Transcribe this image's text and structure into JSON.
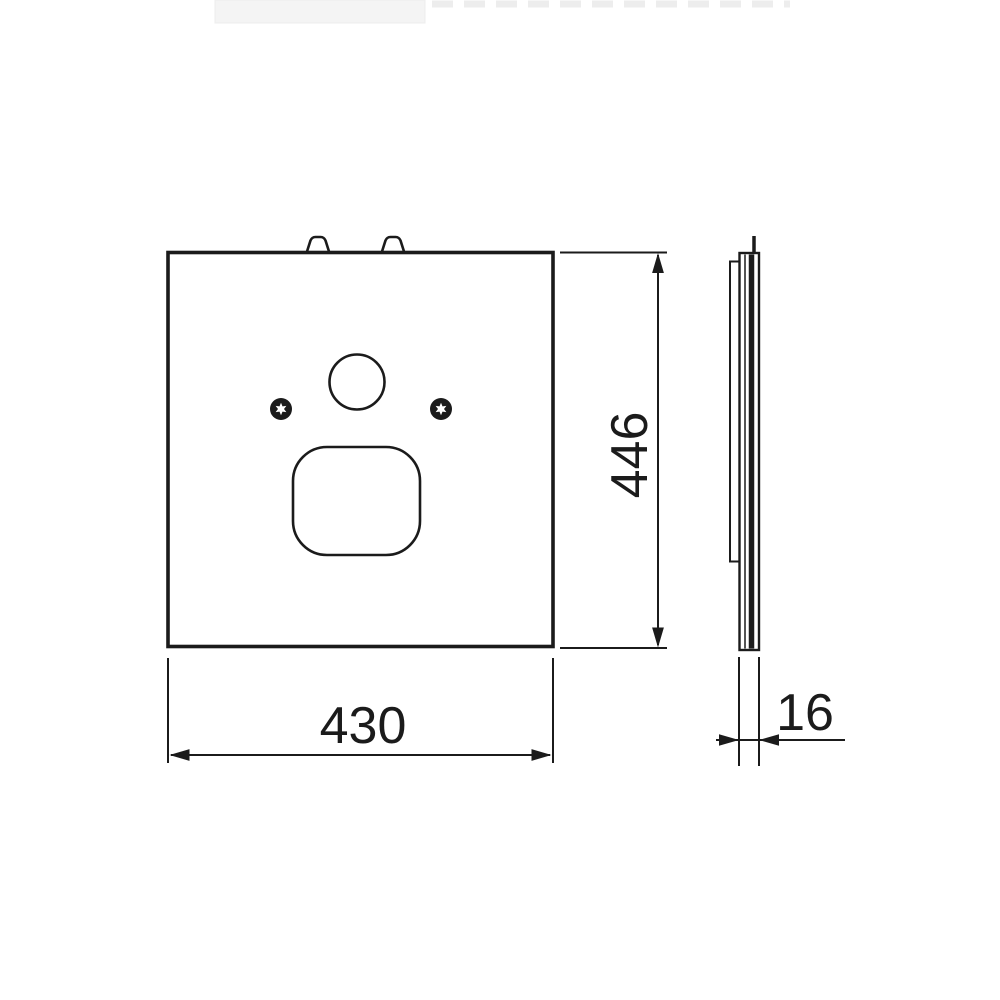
{
  "colors": {
    "ink": "#1b1b1b",
    "background": "#ffffff",
    "crop_artifact": "#f2f2f2"
  },
  "drawing": {
    "kind": "technical-drawing",
    "views": {
      "front": "front-view-panel",
      "side": "side-view-profile"
    }
  },
  "dimensions": {
    "front_width": {
      "label": "430"
    },
    "front_height": {
      "label": "446"
    },
    "side_thickness": {
      "label": "16"
    }
  }
}
